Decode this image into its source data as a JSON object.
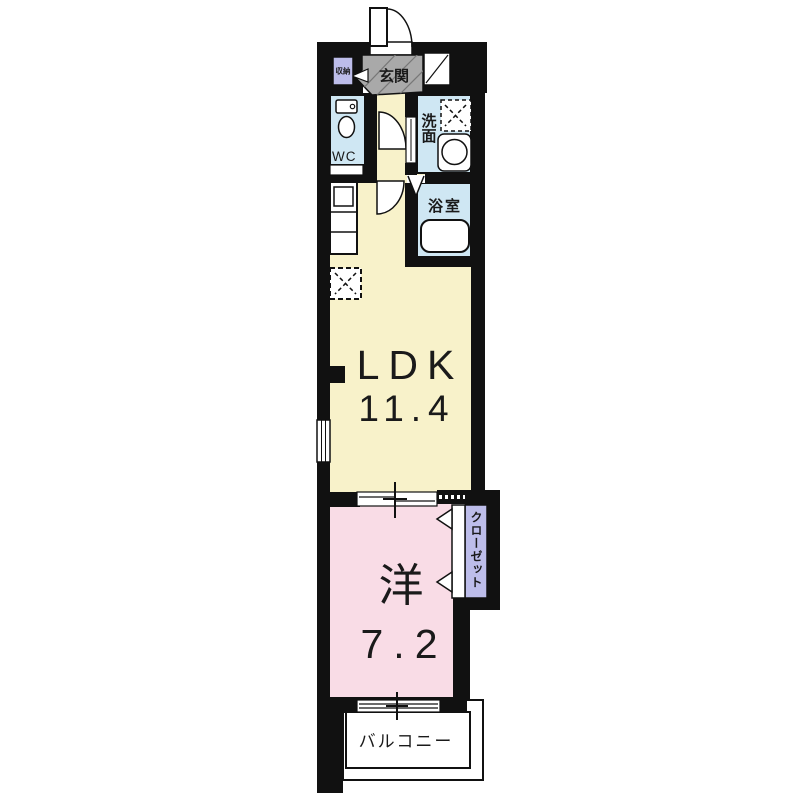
{
  "floorplan": {
    "type_note": "1LDK apartment floor plan",
    "entrance_label": "玄関",
    "entrance_storage_label": "収納",
    "wc_label": "WC",
    "washroom_label": "洗面",
    "bathroom_label": "浴室",
    "ldk_label": "LDK",
    "ldk_size": "11.4",
    "western_room_label": "洋",
    "western_room_size": "7.2",
    "closet_label": "クローゼット",
    "balcony_label": "バルコニー"
  },
  "colors": {
    "wall": "#111111",
    "ldk_fill": "#f8f2ca",
    "western_room_fill": "#f9dce6",
    "wet_area_fill": "#cfe7f3",
    "closet_fill": "#bdbdea",
    "entrance_fill": "#a9a9a9",
    "line": "#111111",
    "background": "#ffffff"
  },
  "icons": {
    "toilet": "toilet-icon",
    "washing_machine": "washing-machine-icon",
    "sink": "sink-icon",
    "bathtub": "bathtub-icon",
    "refrigerator_space": "refrigerator-space-icon",
    "entrance_door_swing": "door-swing-icon",
    "closet_folding_door": "folding-door-arrow-icon"
  }
}
